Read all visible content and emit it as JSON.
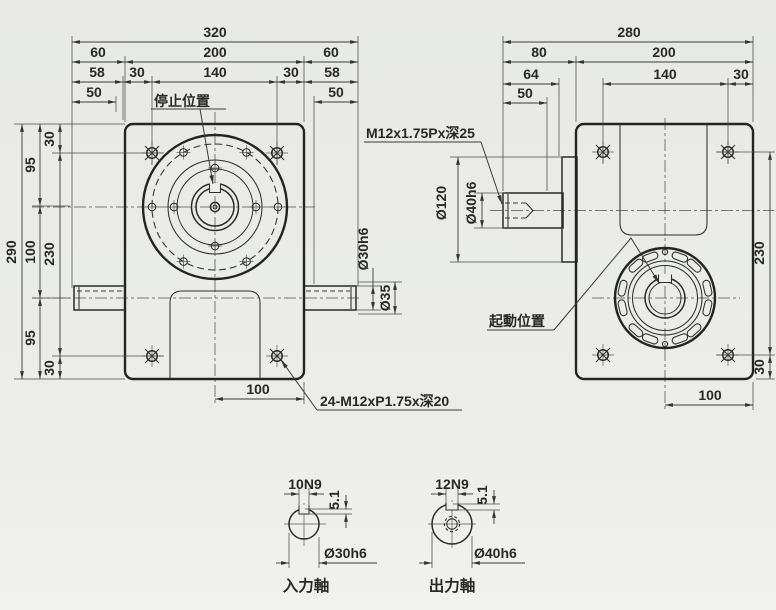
{
  "front": {
    "dim_overall": "320",
    "dim_left": "60",
    "dim_mid": "200",
    "dim_right": "60",
    "dim_r3_1": "58",
    "dim_r3_2": "30",
    "dim_r3_3": "140",
    "dim_r3_4": "30",
    "dim_r3_5": "58",
    "dim_r4_left": "50",
    "dim_r4_right": "50",
    "dim_height": "290",
    "dim_v95_top": "95",
    "dim_v100": "100",
    "dim_v95_bot": "95",
    "dim_v30_top": "30",
    "dim_v230": "230",
    "dim_v30_bot": "30",
    "dim_shaft_dia": "Ø30h6",
    "dim_shoulder_dia": "Ø35",
    "dim_bottom": "100",
    "label_stop_position": "停止位置",
    "note_tapped_holes": "24-M12xP1.75x深20"
  },
  "side": {
    "dim_overall": "280",
    "dim_r2_1": "80",
    "dim_r2_2": "200",
    "dim_r3_1": "64",
    "dim_r3_2": "140",
    "dim_r3_3": "30",
    "dim_r4": "50",
    "dim_boss_dia": "Ø120",
    "dim_shaft_dia": "Ø40h6",
    "note_tapped_hole": "M12x1.75Px深25",
    "label_start_position": "起動位置",
    "dim_v230": "230",
    "dim_v30": "30",
    "dim_bottom": "100"
  },
  "details": {
    "input": {
      "keyway": "10N9",
      "depth": "5.1",
      "dia": "Ø30h6",
      "caption": "入力軸"
    },
    "output": {
      "keyway": "12N9",
      "depth": "5.1",
      "dia": "Ø40h6",
      "caption": "出力軸"
    }
  },
  "colors": {
    "body_green": "#a9bdb0",
    "metal_light": "#f2f2f2",
    "line": "#262626",
    "background": "#ecedeb"
  }
}
